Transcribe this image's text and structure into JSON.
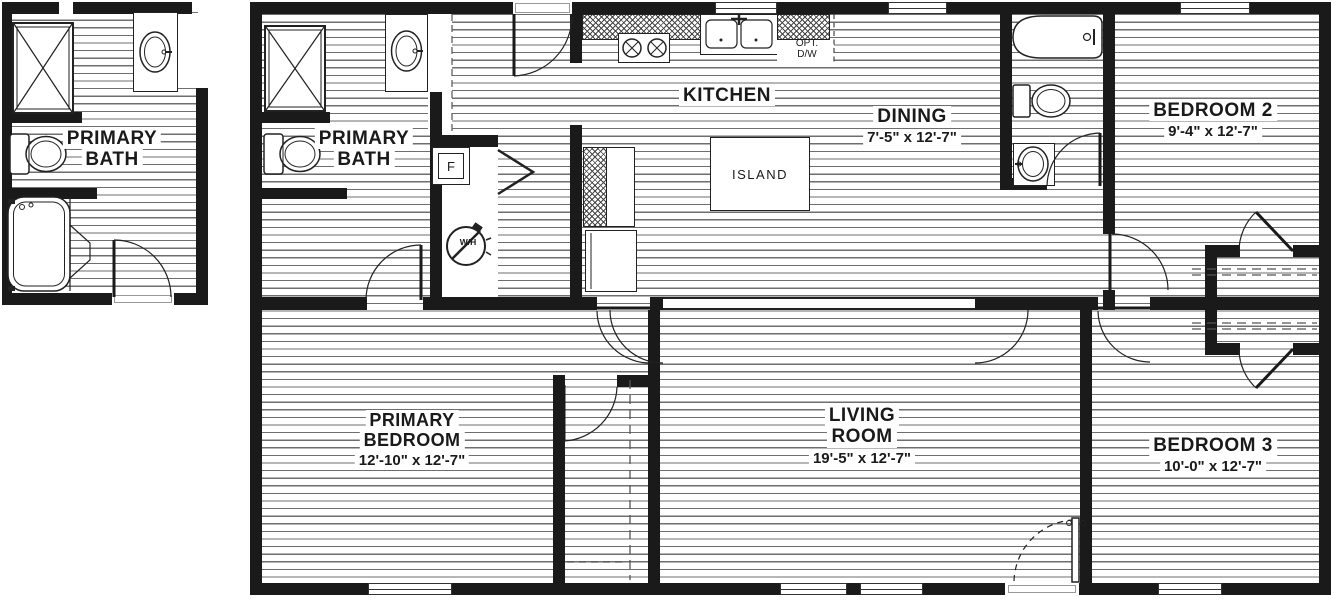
{
  "detail_plan": {
    "room": {
      "line1": "PRIMARY",
      "line2": "BATH"
    }
  },
  "main_plan": {
    "primary_bath": {
      "line1": "PRIMARY",
      "line2": "BATH"
    },
    "kitchen": {
      "name": "KITCHEN"
    },
    "island": {
      "name": "ISLAND"
    },
    "opt_dw": {
      "line1": "OPT.",
      "line2": "D/W"
    },
    "furnace": {
      "label": "F"
    },
    "water_heater": {
      "label": "W/H"
    },
    "dining": {
      "name": "DINING",
      "dims": "7'-5\" x  12'-7\""
    },
    "bedroom2": {
      "name": "BEDROOM 2",
      "dims": "9'-4\" x  12'-7\""
    },
    "primary_bedroom": {
      "line1": "PRIMARY",
      "line2": "BEDROOM",
      "dims": "12'-10\" x  12'-7\""
    },
    "living_room": {
      "line1": "LIVING",
      "line2": "ROOM",
      "dims": "19'-5\" x  12'-7\""
    },
    "bedroom3": {
      "name": "BEDROOM 3",
      "dims": "10'-0\" x  12'-7\""
    }
  },
  "colors": {
    "wall": "#1a1a1a",
    "hatch_line": "#6e6e6e",
    "background": "#ffffff"
  }
}
